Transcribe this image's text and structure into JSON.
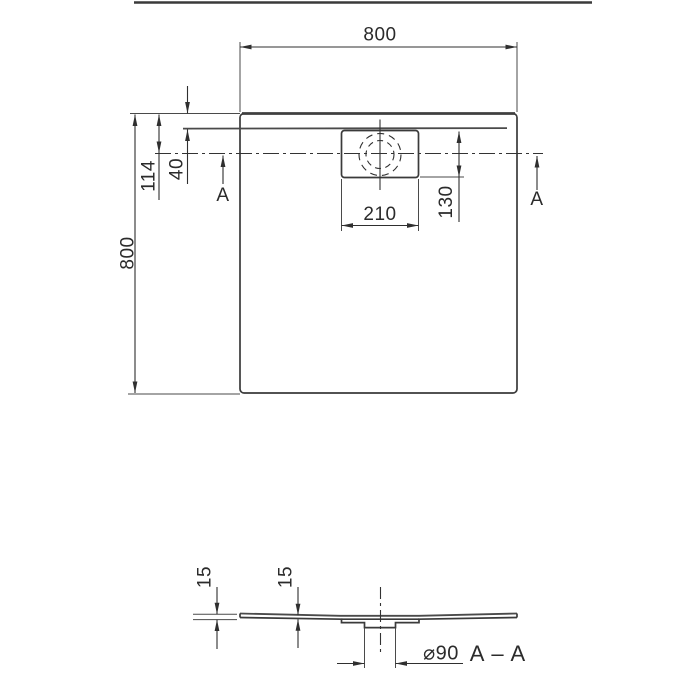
{
  "colors": {
    "background": "#ffffff",
    "ink": "#2f2f2f"
  },
  "plan": {
    "width_label": "800",
    "height_label": "800",
    "rim_inset_label": "40",
    "edge_to_drain_label": "114",
    "drain_width_label": "210",
    "drain_depth_label": "130",
    "section_marker_left": "A",
    "section_marker_right": "A"
  },
  "section": {
    "edge_thickness_label": "15",
    "inner_thickness_label": "15",
    "drain_diameter_label": "⌀90",
    "title": "A – A"
  }
}
